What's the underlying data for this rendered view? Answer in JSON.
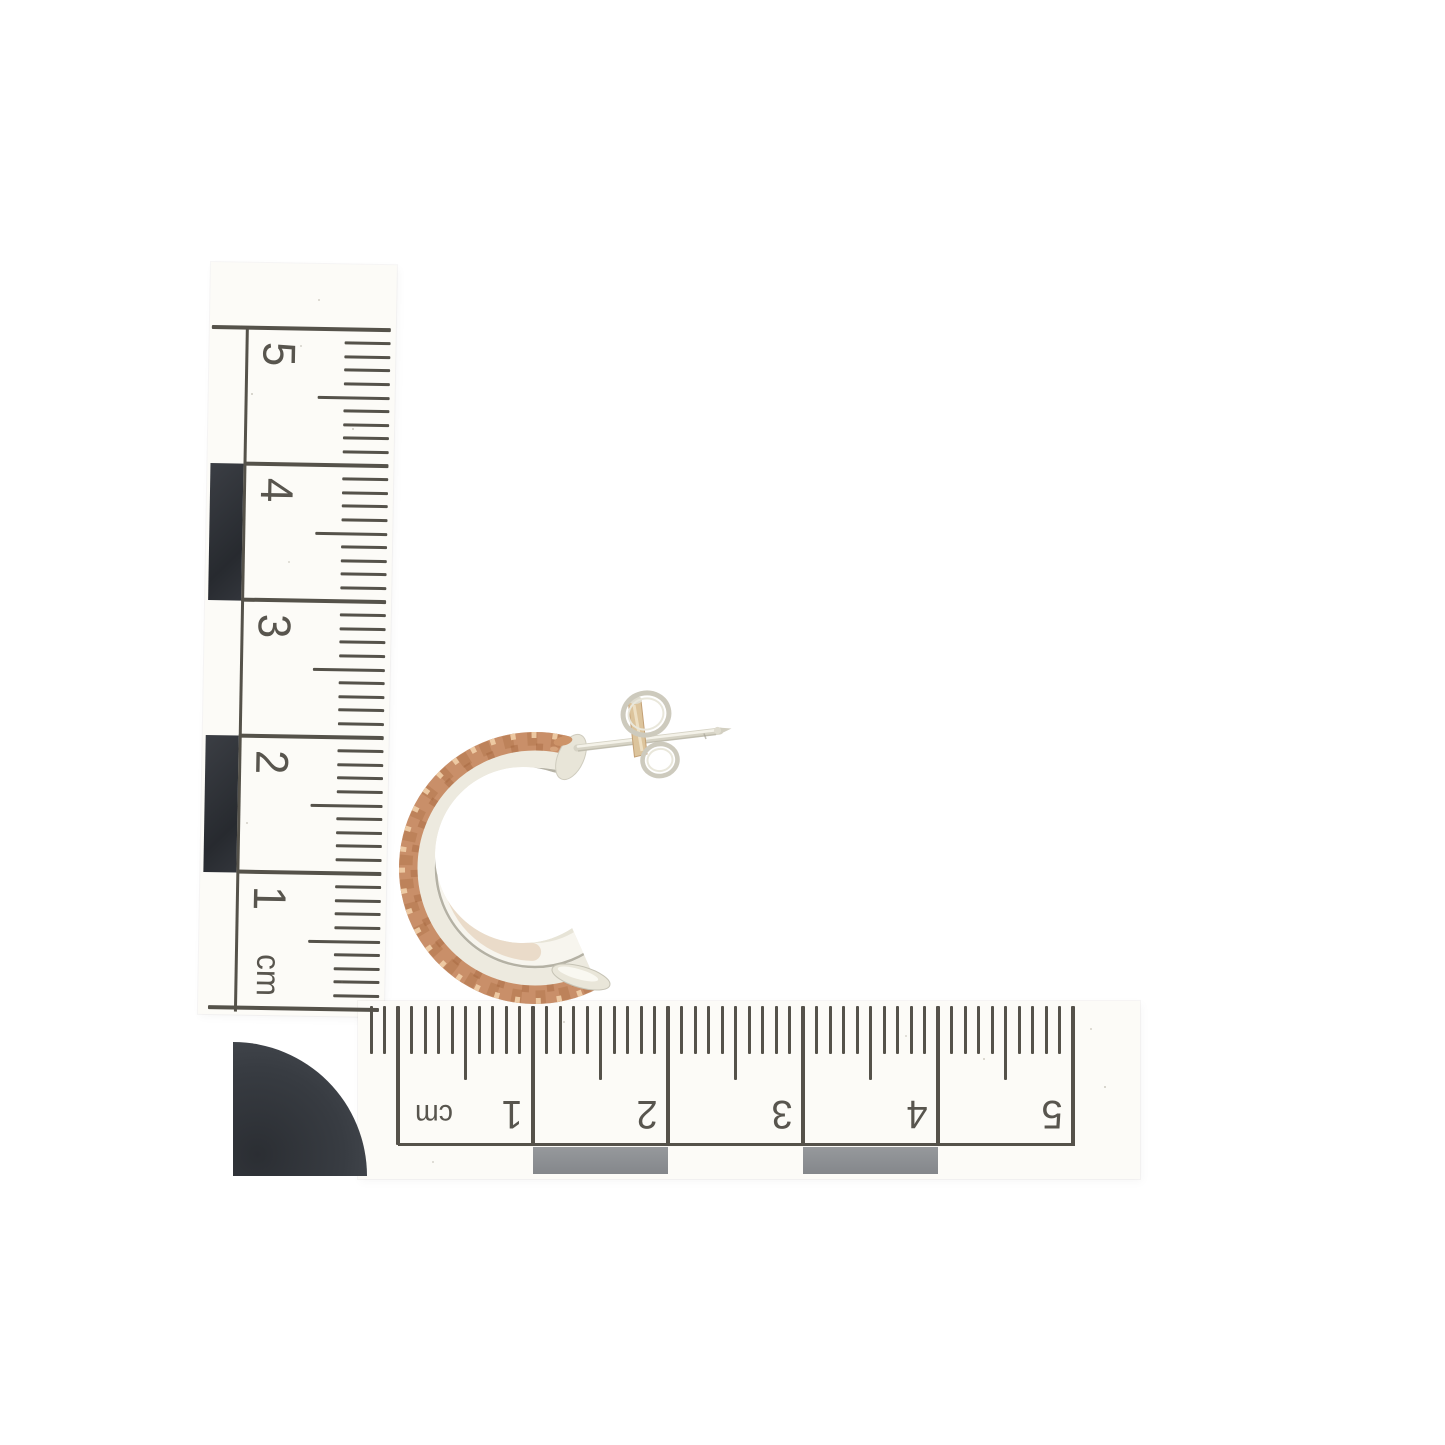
{
  "photo": {
    "subject": "Two-tone half-hoop stud earring with butterfly back beside centimetre scale rulers",
    "background_color": "#ffffff"
  },
  "vertical_ruler": {
    "unit_label": "cm",
    "number_labels": [
      "5",
      "4",
      "3",
      "2",
      "1"
    ],
    "ink_color": "#55524a",
    "paper_color": "#fcfbf7",
    "scale_block_color": "#2f3237"
  },
  "horizontal_ruler": {
    "unit_label": "cm",
    "number_labels": [
      "1",
      "2",
      "3",
      "4",
      "5"
    ],
    "ink_color": "#55524a",
    "paper_color": "#fcfbf7",
    "scale_bar_color": "#8d9093"
  },
  "corner_marker": {
    "color": "#34373d"
  },
  "earring": {
    "silver_color": "#eceade",
    "rose_gold_color": "#ca9067",
    "parts": {
      "hoop": "half hoop with rose gold patterned rim",
      "post": "silver post",
      "back": "butterfly back"
    }
  }
}
